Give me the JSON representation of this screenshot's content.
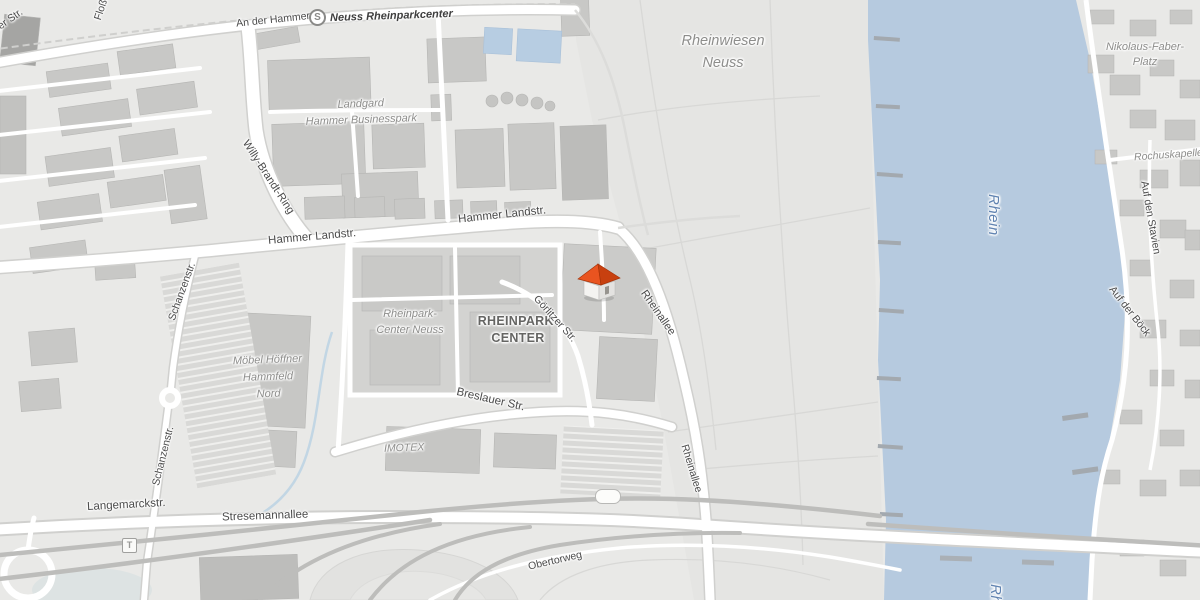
{
  "map": {
    "description": "Grayscale street map of the Rheinpark-Center area in Neuss with a red house location marker near Goerlitzer Str.",
    "colors": {
      "land": "#e9e9e7",
      "water": "#b6cadf",
      "building": "#c8c8c6",
      "road": "#ffffff",
      "motorway": "#bdbdbb",
      "street_label": "#4a4a4a",
      "area_label": "#8d8d8b",
      "water_label": "#6083b1",
      "marker_roof": "#e95420",
      "marker_roof_shade": "#c8400f",
      "marker_wall": "#f4f3f1"
    },
    "icons": {
      "station": "S",
      "tram_stop": "T",
      "house_marker": "house-3d",
      "motorway_badge": ""
    },
    "labels": {
      "an_der_hammer_br": "An der Hammer Br.",
      "station_name": "Neuss Rheinparkcenter",
      "rheinwiesen_line1": "Rheinwiesen",
      "rheinwiesen_line2": "Neuss",
      "nikolaus_line1": "Nikolaus-Faber-",
      "nikolaus_line2": "Platz",
      "rochuskapelle": "Rochuskapelle",
      "landgard": "Landgard",
      "hammer_businesspark": "Hammer Businesspark",
      "willy_brandt_ring": "Willy-Brandt-Ring",
      "hammer_landstr_west": "Hammer Landstr.",
      "hammer_landstr_east": "Hammer Landstr.",
      "schanzenstr_north": "Schanzenstr.",
      "schanzenstr_south": "Schanzenstr.",
      "rheinpark_center_neuss_line1": "Rheinpark-",
      "rheinpark_center_neuss_line2": "Center Neuss",
      "rheinpark_center_line1": "RHEINPARK-",
      "rheinpark_center_line2": "CENTER",
      "goerlitzer_str": "Görlitzer Str.",
      "rheinallee_north": "Rheinallee",
      "rheinallee_south": "Rheinallee",
      "moebel_line1": "Möbel Höffner",
      "moebel_line2": "Hammfeld",
      "moebel_line3": "Nord",
      "breslauer_str": "Breslauer Str.",
      "imotex": "IMOTEX",
      "langemarckstr": "Langemarckstr.",
      "stresemannallee": "Stresemannallee",
      "obertorweg": "Obertorweg",
      "rhein": "Rhein",
      "rhein_south": "Rhein",
      "auf_den_stavien": "Auf den Stavien",
      "auf_der_boeck": "Auf der Böck",
      "hammer_str_partial": "Hammer Str.",
      "flosshafenstr_partial": "Floßhafenstr."
    }
  }
}
